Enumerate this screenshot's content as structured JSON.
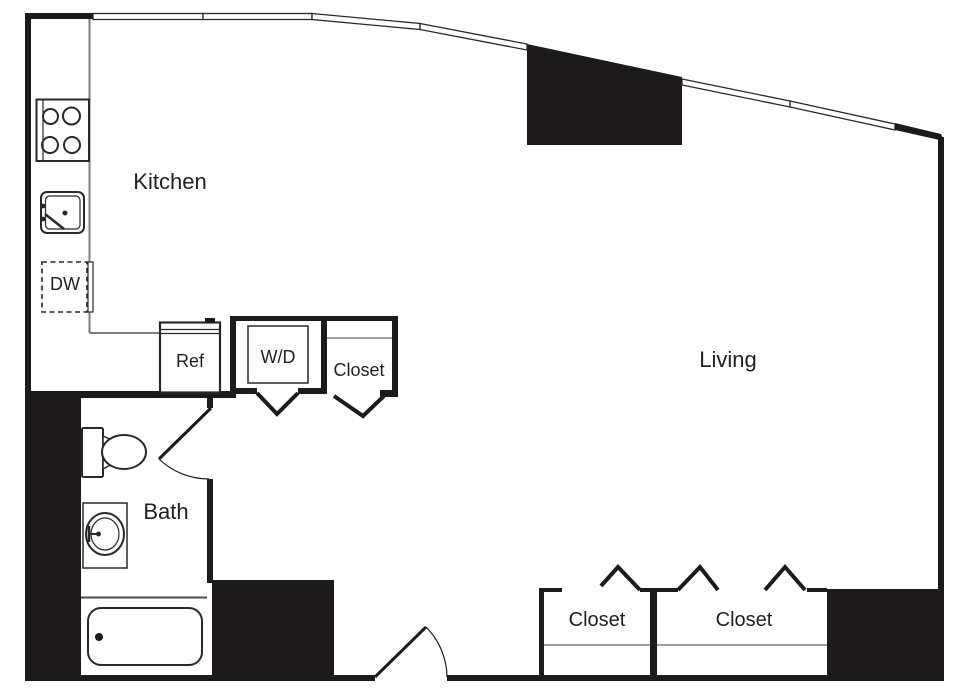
{
  "plan": {
    "title": "Studio apartment floor plan",
    "rooms": {
      "kitchen": "Kitchen",
      "living": "Living",
      "bath": "Bath"
    },
    "fixtures": {
      "dishwasher": "DW",
      "refrigerator": "Ref",
      "washer_dryer": "W/D"
    },
    "closets": {
      "upper": "Closet",
      "lower_left": "Closet",
      "lower_right": "Closet"
    },
    "colors": {
      "wall": "#1d1a1b",
      "line": "#2b2828",
      "counter_line": "#7d7d7d",
      "text": "#231f20",
      "background": "#ffffff"
    }
  }
}
